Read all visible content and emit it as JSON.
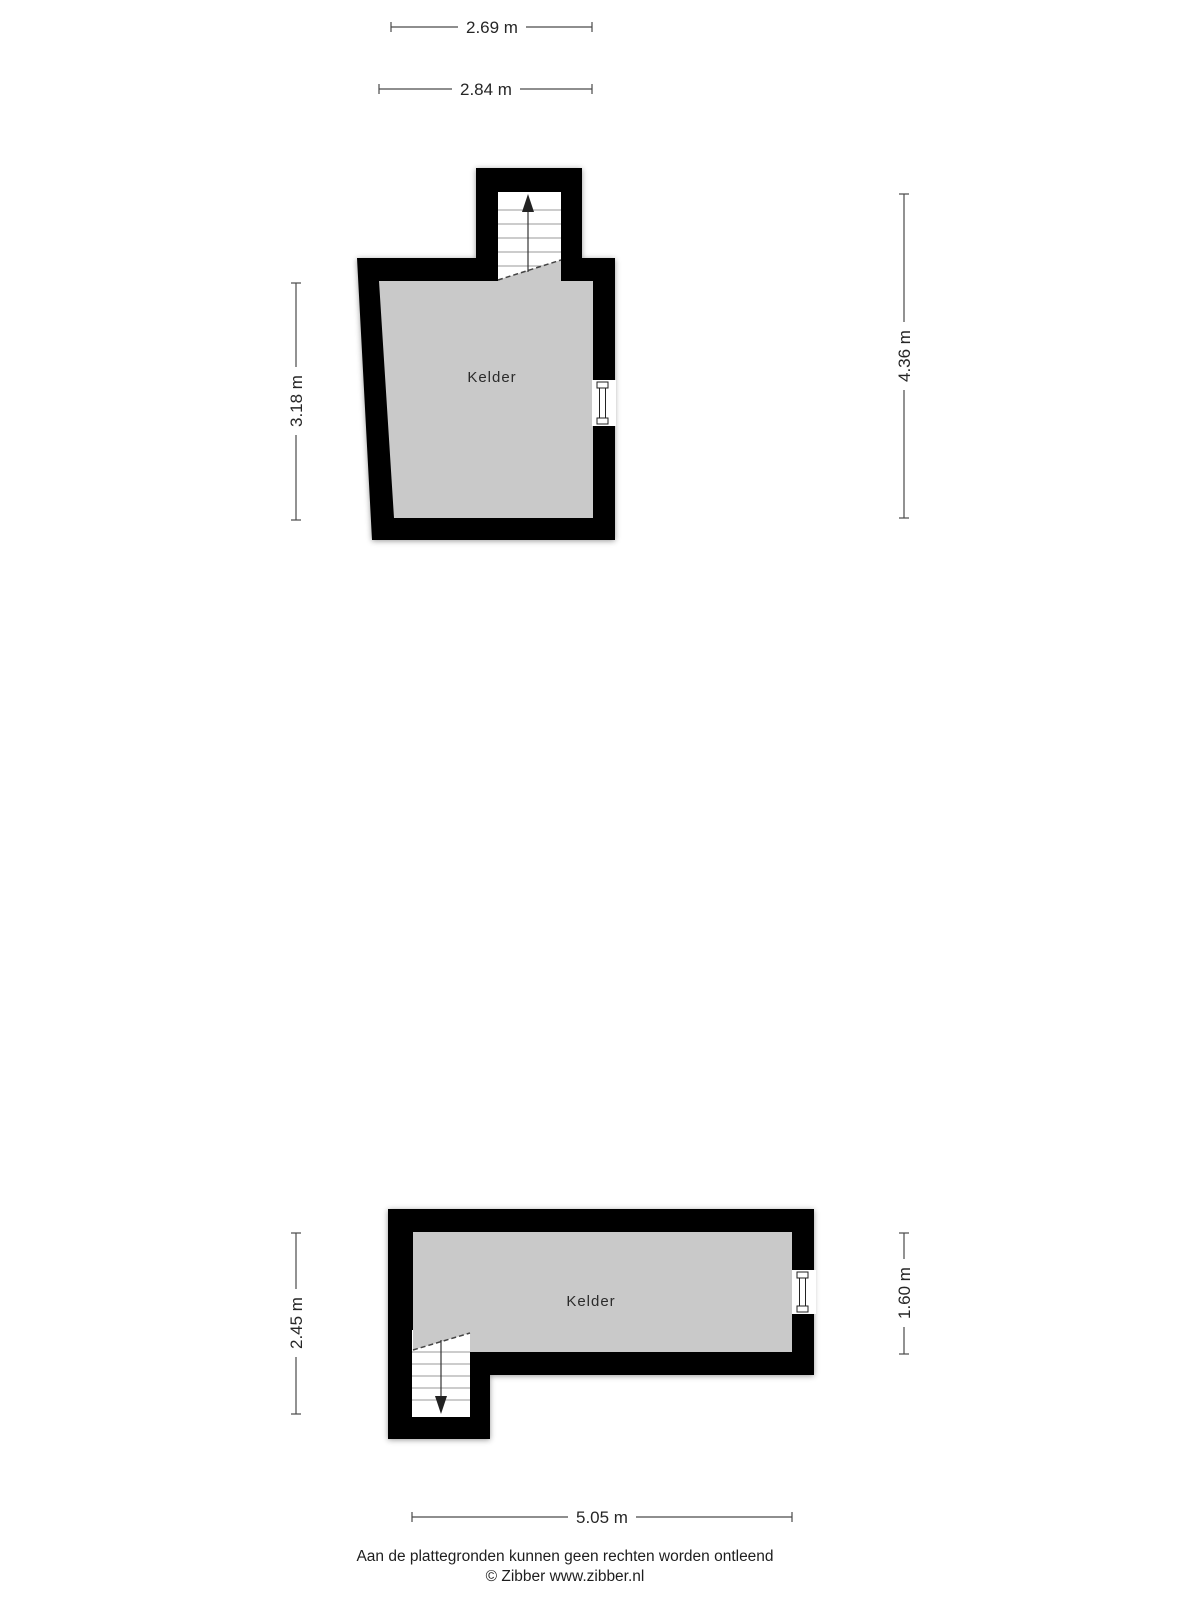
{
  "colors": {
    "wall": "#000000",
    "room_fill": "#c9c9c9",
    "dim_line": "#4a4a4a",
    "dim_text": "#262626",
    "background": "#ffffff"
  },
  "plans": {
    "top": {
      "room_label": "Kelder",
      "stairs_direction": "up",
      "dimensions": {
        "top_inner": "2.69 m",
        "top_outer": "2.84 m",
        "left": "3.18 m",
        "right": "4.36 m"
      }
    },
    "bottom": {
      "room_label": "Kelder",
      "stairs_direction": "down",
      "dimensions": {
        "left": "2.45 m",
        "right": "1.60 m",
        "bottom": "5.05 m"
      }
    }
  },
  "footer": {
    "disclaimer": "Aan de plattegronden kunnen geen rechten worden ontleend",
    "copyright": "© Zibber www.zibber.nl"
  }
}
